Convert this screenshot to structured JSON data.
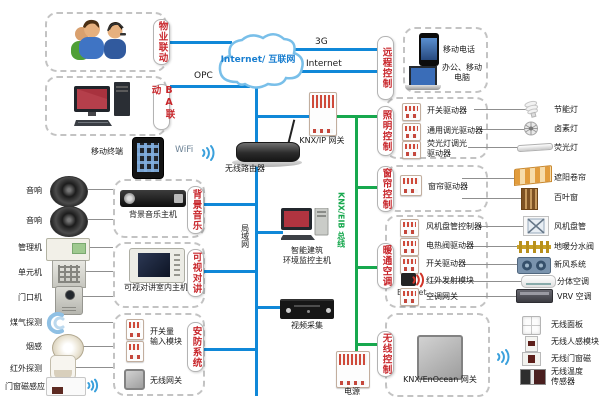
{
  "colors": {
    "blue_line": "#1088d8",
    "green_line": "#17a84e",
    "label_red": "#c8262b"
  },
  "cloud": {
    "label": "Internet/ 互联网"
  },
  "lines": {
    "opc": "OPC",
    "g3": "3G",
    "internet": "Internet",
    "wifi": "WiFi",
    "lan": "局域网",
    "knx_bus": "KNX/EIB 总线",
    "rf": "RF",
    "bacnet": "BACnet"
  },
  "linkage": {
    "property": "物业联动",
    "ba": "BA联动"
  },
  "backbone": {
    "mobile_terminal": "移动终端",
    "router": "无线路由器",
    "knx_ip_gateway": "KNX/IP 网关",
    "monitor_host": "智能建筑\n环境监控主机",
    "video_capture": "视频采集",
    "power": "电源"
  },
  "remote": {
    "title": "远程控制",
    "items": [
      "移动电话",
      "办公、移动\n电脑"
    ]
  },
  "lighting": {
    "title": "照明控制",
    "devices": [
      "开关驱动器",
      "通用调光驱动器",
      "荧光灯调光\n驱动器"
    ],
    "loads": [
      "节能灯",
      "卤素灯",
      "荧光灯"
    ]
  },
  "curtain": {
    "title": "窗帘控制",
    "devices": [
      "窗帘驱动器"
    ],
    "loads": [
      "遮阳卷帘",
      "百叶窗"
    ]
  },
  "hvac": {
    "title": "暖通空调",
    "devices": [
      "风机盘管控制器",
      "电热阀驱动器",
      "开关驱动器",
      "红外发射模块",
      "空调网关"
    ],
    "loads": [
      "风机盘管",
      "地暖分水阀",
      "新风系统",
      "分体空调",
      "VRV 空调"
    ]
  },
  "wireless": {
    "title": "无线控制",
    "gateway": "KNX/EnOcean 网关",
    "loads": [
      "无线面板",
      "无线人感模块",
      "无线门窗磁",
      "无线温度\n传感器"
    ]
  },
  "music": {
    "title": "背景音乐",
    "device": "背景音乐主机"
  },
  "intercom": {
    "title": "可视对讲",
    "device": "可视对讲室内主机"
  },
  "security": {
    "title": "安防系统",
    "devices": [
      "开关量\n输入模块",
      "无线网关"
    ]
  },
  "peripherals": [
    "音响",
    "音响",
    "管理机",
    "单元机",
    "门口机",
    "煤气探测",
    "烟感",
    "红外探测",
    "门窗磁感应"
  ]
}
